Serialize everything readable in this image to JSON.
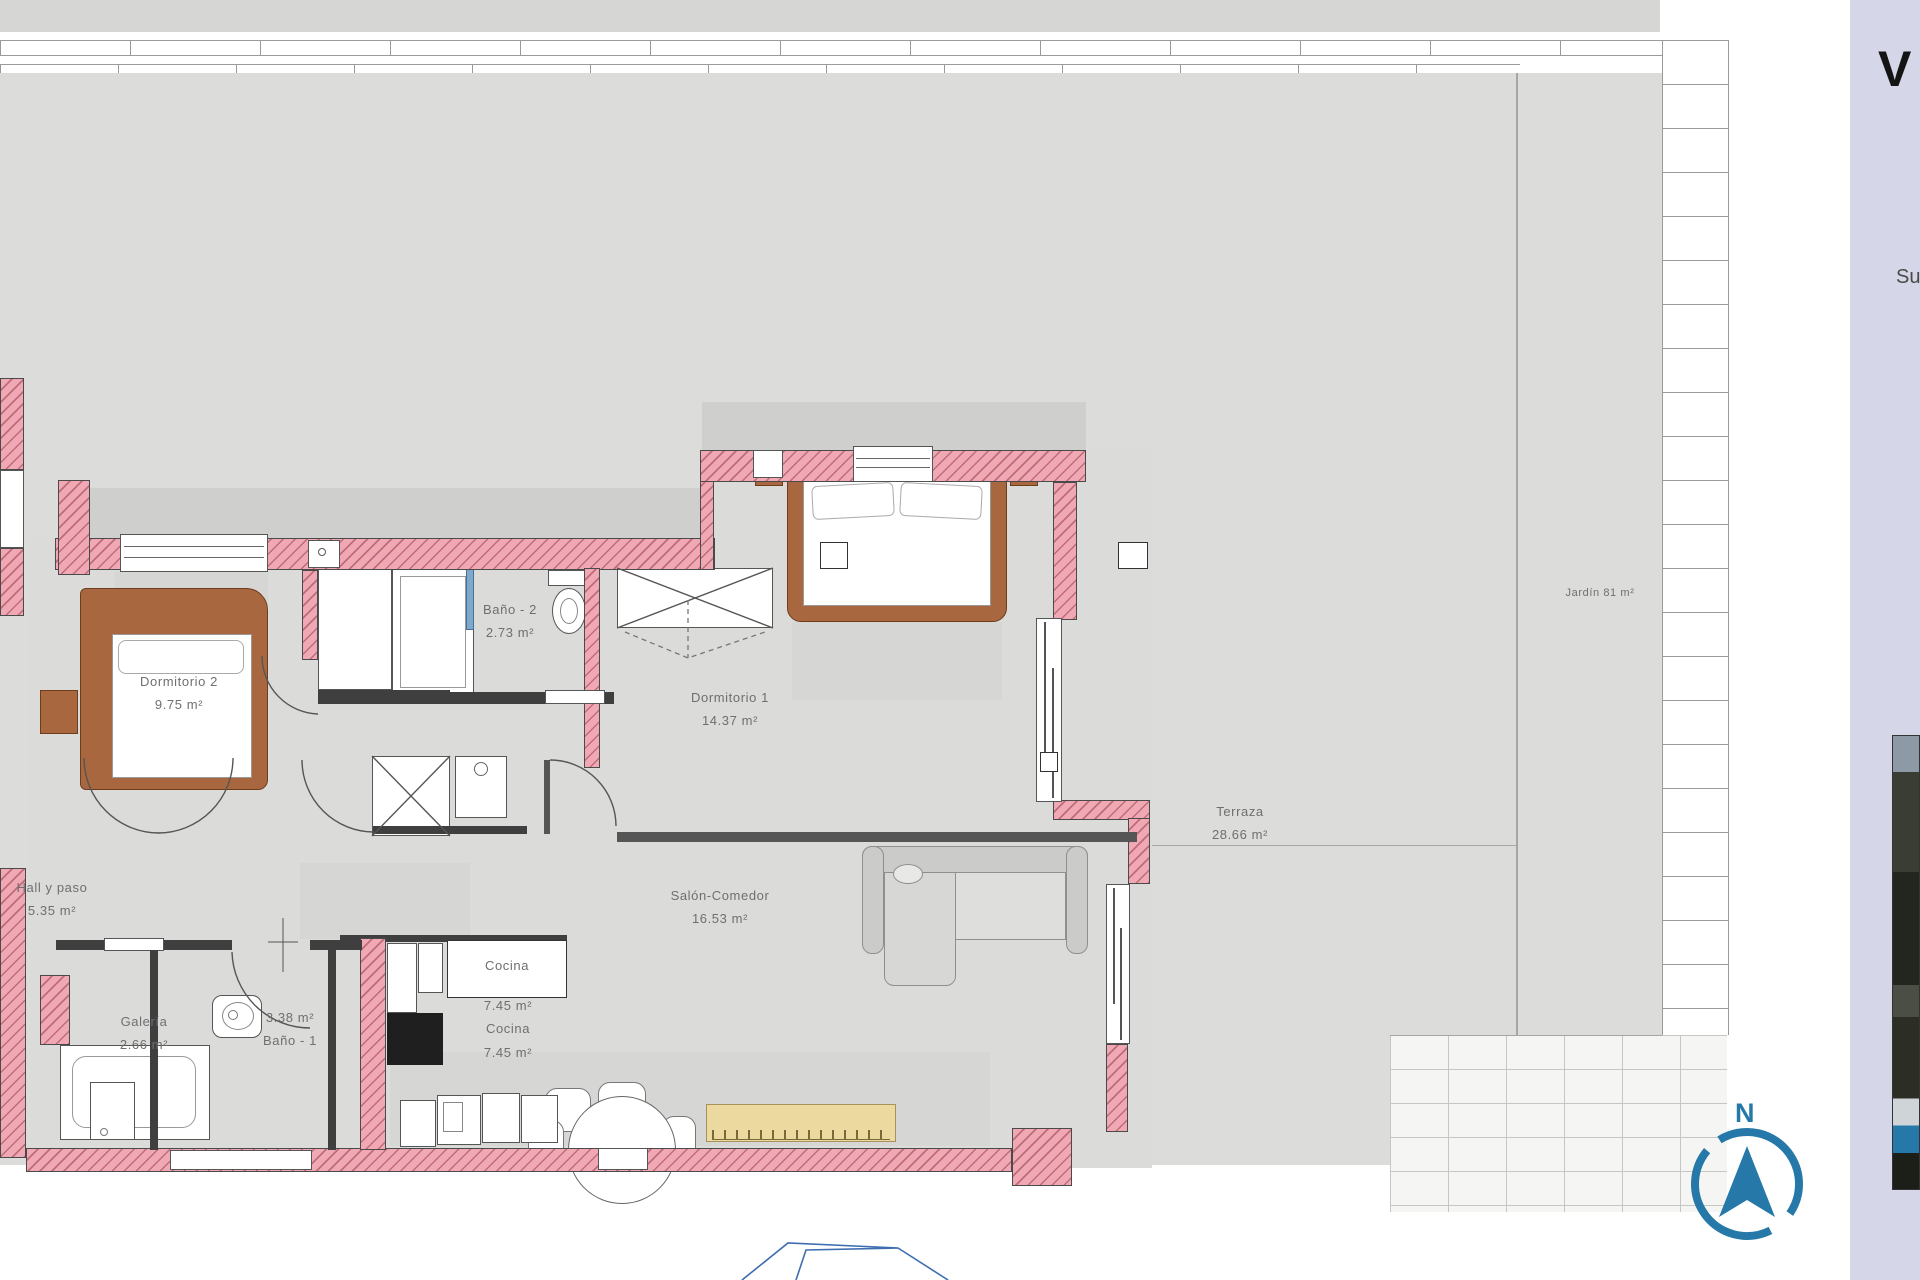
{
  "plan": {
    "rooms": [
      {
        "name": "Dormitorio 2",
        "area": "9.75 m²"
      },
      {
        "name": "Baño - 2",
        "area": "2.73 m²"
      },
      {
        "name": "Dormitorio 1",
        "area": "14.37 m²"
      },
      {
        "name": "Hall y paso",
        "area": "5.35 m²"
      },
      {
        "name": "Galería",
        "area": "2.66 m²"
      },
      {
        "name": "Baño - 1",
        "area": "3.38 m²"
      },
      {
        "name": "Cocina",
        "area": "7.45 m²"
      },
      {
        "name": "Salón-Comedor",
        "area": "16.53 m²"
      },
      {
        "name": "Terraza",
        "area": "28.66 m²"
      }
    ],
    "garden_label": "Jardín 81 m²",
    "compass_north": "N"
  },
  "sidebar": {
    "heading_partial": "V",
    "caption_partial": "Su"
  },
  "colors": {
    "wall_pink": "#f0a9b4",
    "floor_gray": "#dbdbd9",
    "outdoor_gray": "#dcdcda",
    "compass_blue": "#2678a8",
    "sidebar_lavender": "#d5d6e8",
    "wood_brown": "#a8673e",
    "sideboard_yellow": "#ecd9a0"
  }
}
